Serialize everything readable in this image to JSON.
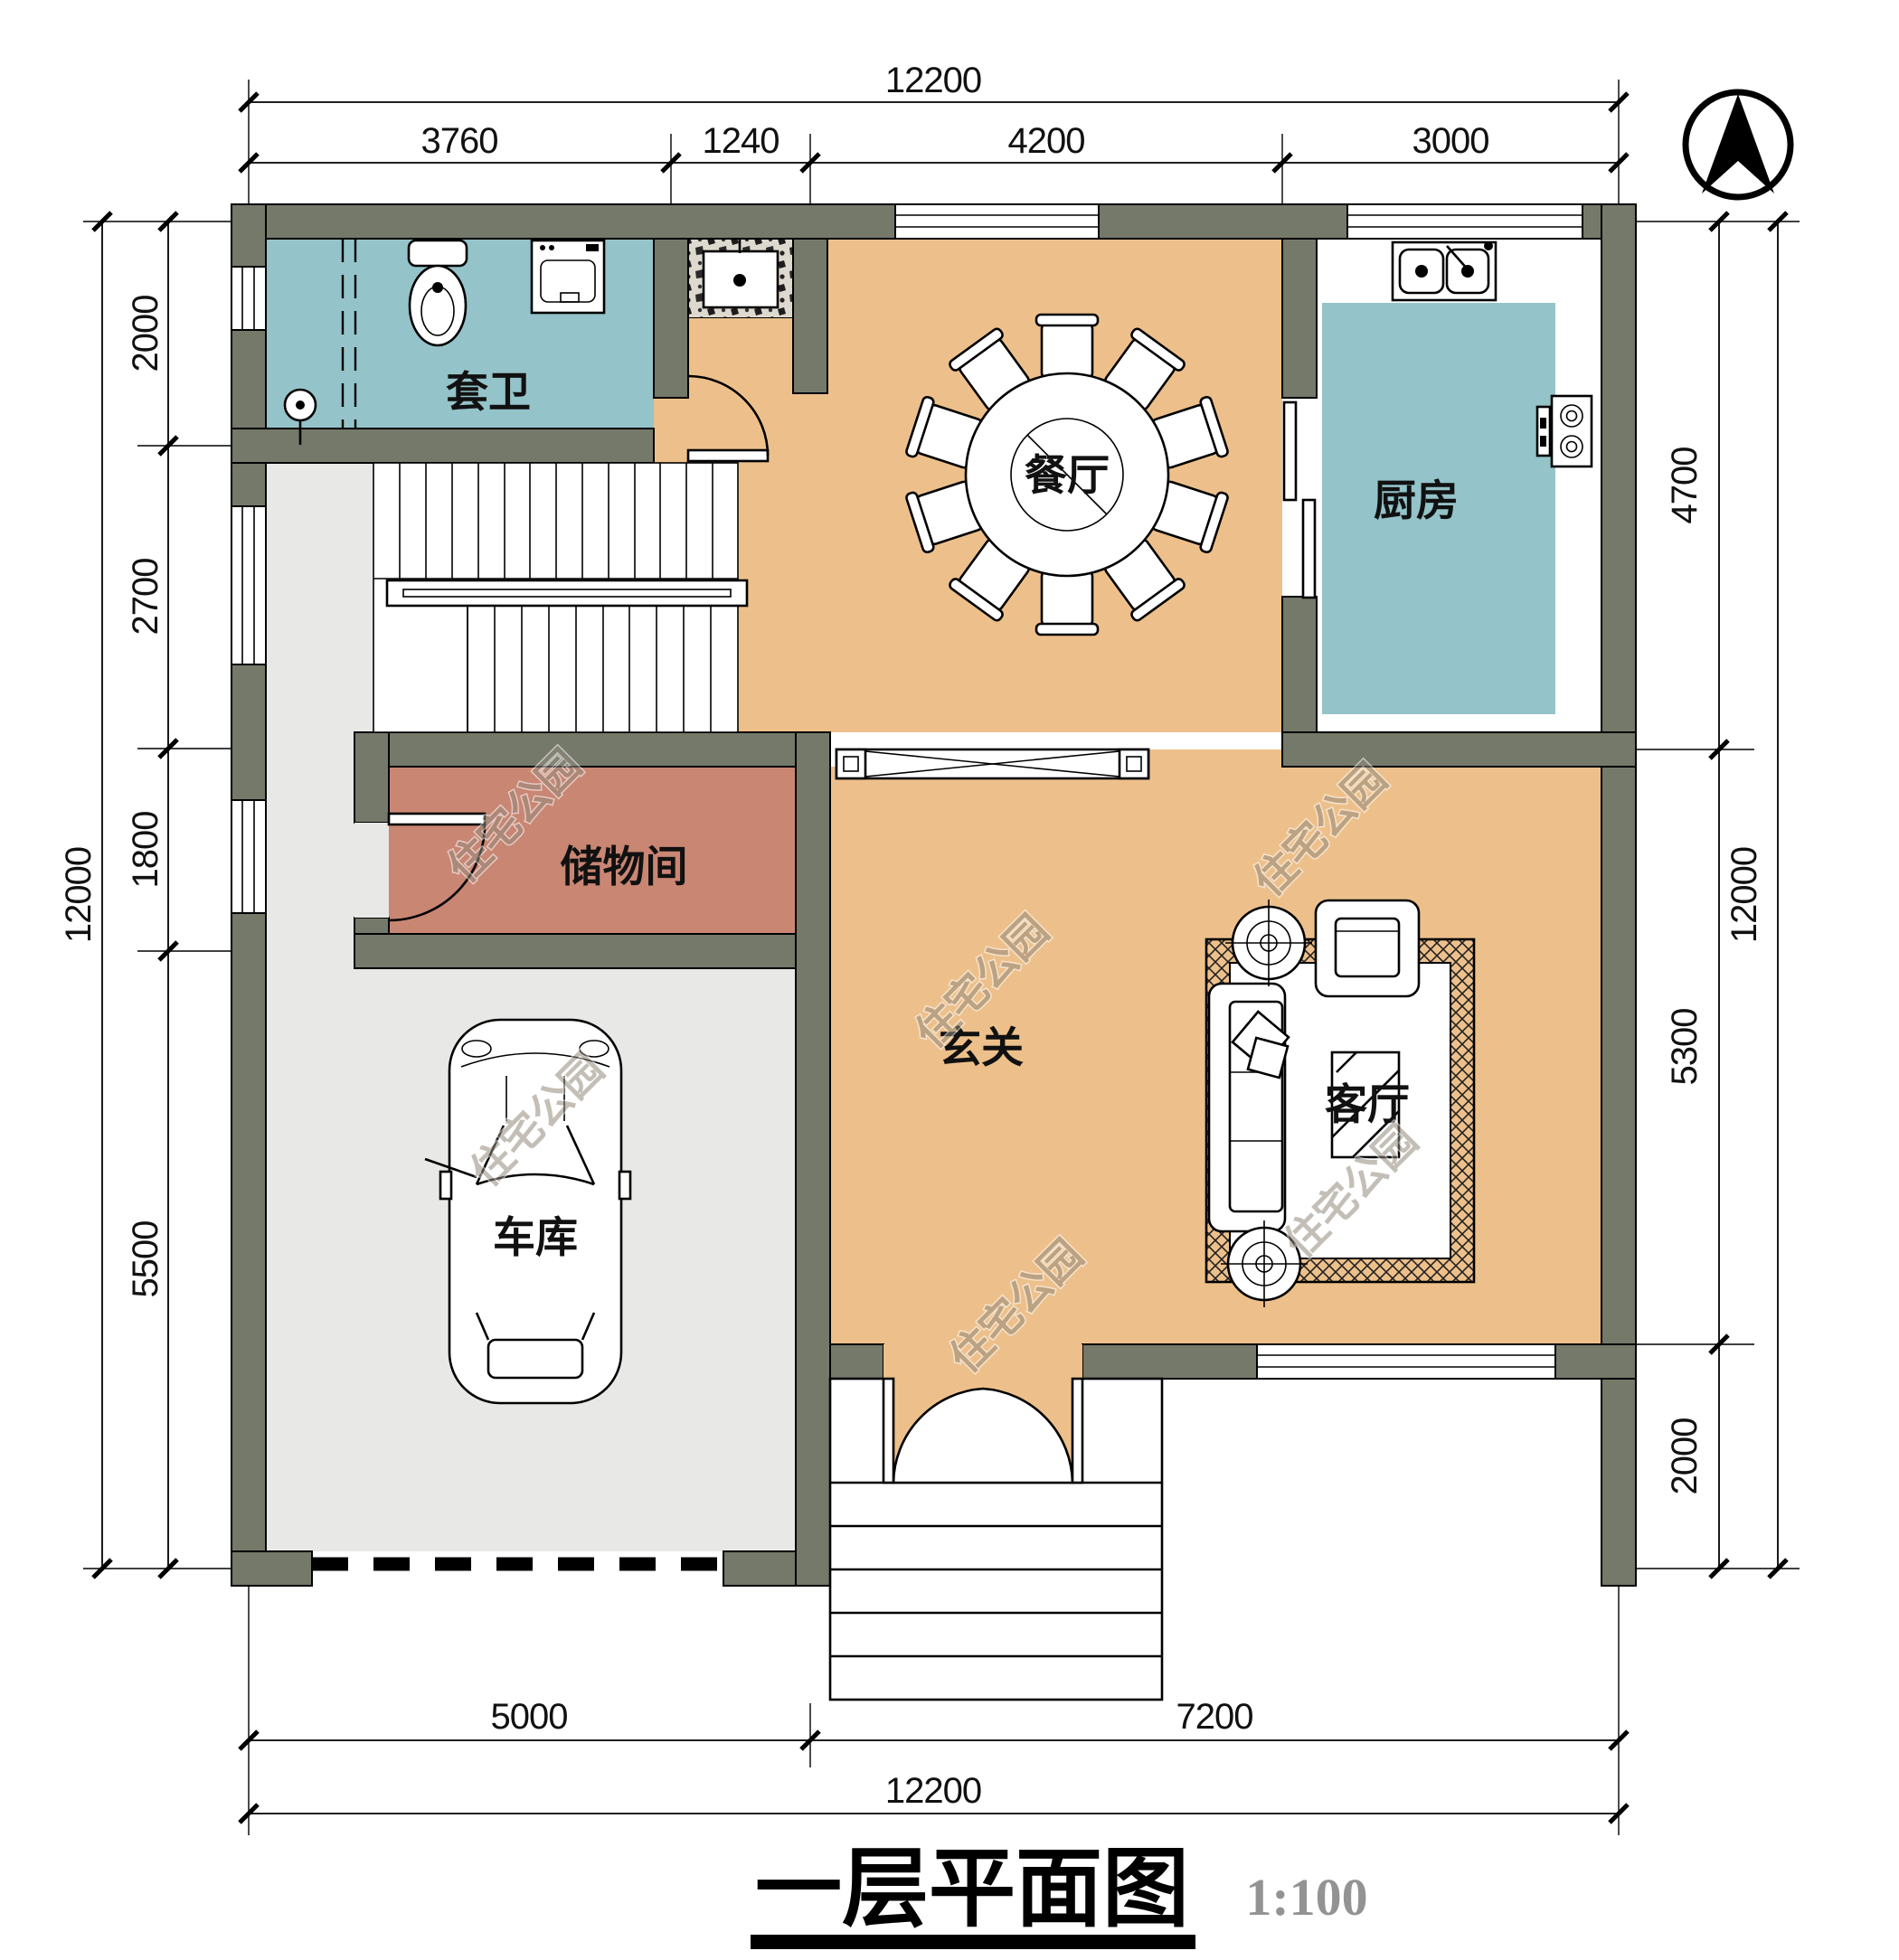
{
  "title": {
    "text": "一层平面图",
    "scale": "1:100"
  },
  "watermark": {
    "text": "住宅公园"
  },
  "rooms": {
    "bathroom": {
      "label": "套卫"
    },
    "dining": {
      "label": "餐厅"
    },
    "kitchen": {
      "label": "厨房"
    },
    "storage": {
      "label": "储物间"
    },
    "hall": {
      "label": "玄关"
    },
    "garage": {
      "label": "车库"
    },
    "living": {
      "label": "客厅"
    }
  },
  "dimensions": {
    "top": {
      "total": "12200",
      "segments": [
        "3760",
        "1240",
        "4200",
        "3000"
      ]
    },
    "bottom": {
      "total": "12200",
      "segments": [
        "5000",
        "7200"
      ]
    },
    "left": {
      "total": "12000",
      "segments": [
        "2000",
        "2700",
        "1800",
        "5500"
      ]
    },
    "right": {
      "total": "12000",
      "segments": [
        "4700",
        "5300",
        "2000"
      ]
    }
  },
  "colors": {
    "wall": "#75796a",
    "floor_main": "#edc08b",
    "floor_wet": "#94c3c9",
    "floor_storage": "#c98673",
    "floor_garage": "#e8e8e6",
    "watermark": "#938b7d"
  }
}
